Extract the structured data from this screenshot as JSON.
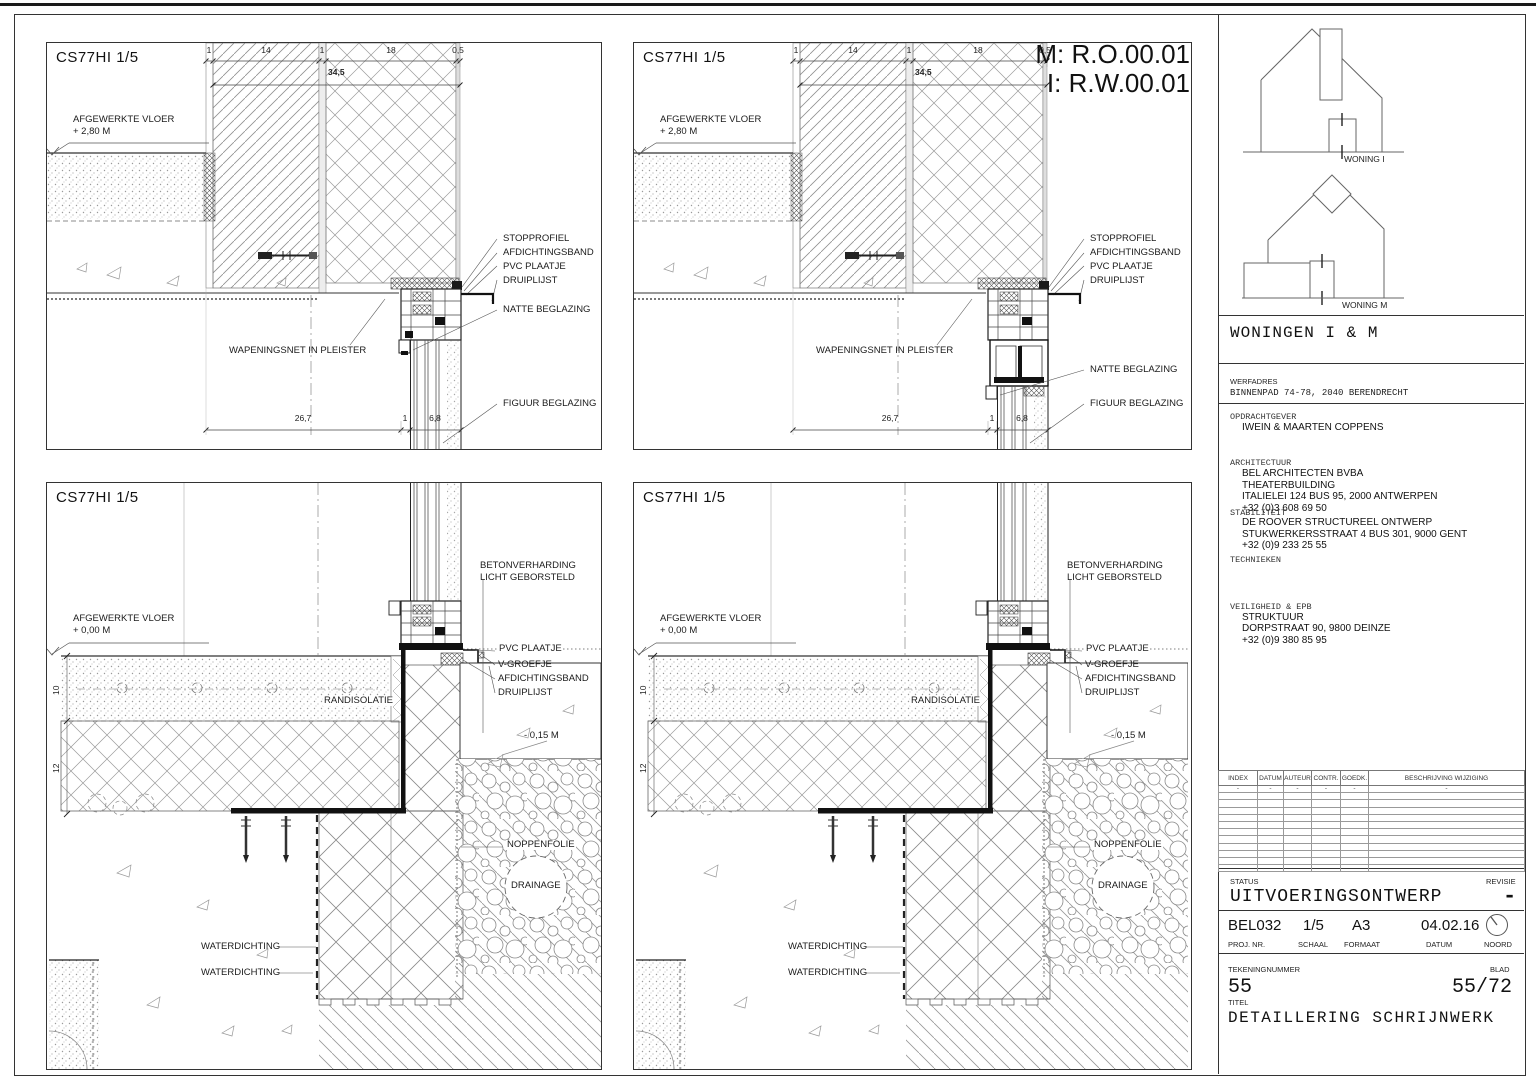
{
  "ref_labels": {
    "m": "M: R.O.00.01",
    "i": "I: R.W.00.01"
  },
  "panel_codes": {
    "tl": "CS77HI 1/5",
    "tr": "CS77HI 1/5",
    "bl": "CS77HI 1/5",
    "br": "CS77HI 1/5"
  },
  "top_labels": {
    "floor1": "AFGEWERKTE VLOER",
    "floor2": "+ 2,80 M",
    "stopprofiel": "STOPPROFIEL",
    "afdichtingsband": "AFDICHTINGSBAND",
    "pvc": "PVC PLAATJE",
    "druiplijst": "DRUIPLIJST",
    "natte": "NATTE BEGLAZING",
    "figuur": "FIGUUR BEGLAZING",
    "wapeningsnet": "WAPENINGSNET IN PLEISTER"
  },
  "top_dims": {
    "d1": "1",
    "d2": "14",
    "d3": "1",
    "d4": "18",
    "d5": "0,5",
    "total": "34,5",
    "b1": "26,7",
    "b2": "1",
    "b3": "6,8"
  },
  "bottom_labels": {
    "floor1": "AFGEWERKTE VLOER",
    "floor2": "+ 0,00 M",
    "beton1": "BETONVERHARDING",
    "beton2": "LICHT GEBORSTELD",
    "pvc": "PVC PLAATJE",
    "vgroefje": "V-GROEFJE",
    "afdichtingsband": "AFDICHTINGSBAND",
    "druiplijst": "DRUIPLIJST",
    "randisolatie": "RANDISOLATIE",
    "level": "- 0,15 M",
    "noppenfolie": "NOPPENFOLIE",
    "drainage": "DRAINAGE",
    "waterdichting": "WATERDICHTING"
  },
  "bottom_dims": {
    "v1": "10",
    "v2": "12"
  },
  "titleblock": {
    "woning_i": "WONING I",
    "woning_m": "WONING M",
    "project_title": "WONINGEN I & M",
    "werfadres_label": "WERFADRES",
    "werfadres": "BINNENPAD 74-78, 2040 BERENDRECHT",
    "opdrachtgever_label": "OPDRACHTGEVER",
    "opdrachtgever": "IWEIN & MAARTEN COPPENS",
    "architectuur_label": "ARCHITECTUUR",
    "architectuur": [
      "BEL ARCHITECTEN BVBA",
      "THEATERBUILDING",
      "ITALIELEI 124 BUS 95, 2000 ANTWERPEN",
      "+32 (0)3 608 69 50"
    ],
    "stabiliteit_label": "STABILITEIT",
    "stabiliteit": [
      "DE ROOVER STRUCTUREEL ONTWERP",
      "STUKWERKERSSTRAAT 4 BUS 301, 9000 GENT",
      "+32 (0)9 233 25 55"
    ],
    "technieken_label": "TECHNIEKEN",
    "veiligheid_label": "VEILIGHEID & EPB",
    "veiligheid": [
      "STRUKTUUR",
      "DORPSTRAAT 90, 9800 DEINZE",
      "+32 (0)9 380 85 95"
    ],
    "revision": {
      "headers": [
        "INDEX",
        "DATUM",
        "AUTEUR",
        "CONTR.",
        "GOEDK.",
        "BESCHRIJVING WIJZIGING"
      ],
      "first_row": [
        "-",
        "-",
        "-",
        "-",
        "-",
        "-"
      ]
    },
    "status_label": "STATUS",
    "status": "UITVOERINGSONTWERP",
    "revisie_label": "REVISIE",
    "revisie": "-",
    "proj_nr": "BEL032",
    "proj_nr_label": "PROJ. NR.",
    "schaal": "1/5",
    "schaal_label": "SCHAAL",
    "formaat": "A3",
    "formaat_label": "FORMAAT",
    "datum": "04.02.16",
    "datum_label": "DATUM",
    "noord_label": "NOORD",
    "tekeningnummer_label": "TEKENINGNUMMER",
    "tekeningnummer": "55",
    "blad_label": "BLAD",
    "blad": "55/72",
    "titel_label": "TITEL",
    "titel": "DETAILLERING SCHRIJNWERK"
  }
}
